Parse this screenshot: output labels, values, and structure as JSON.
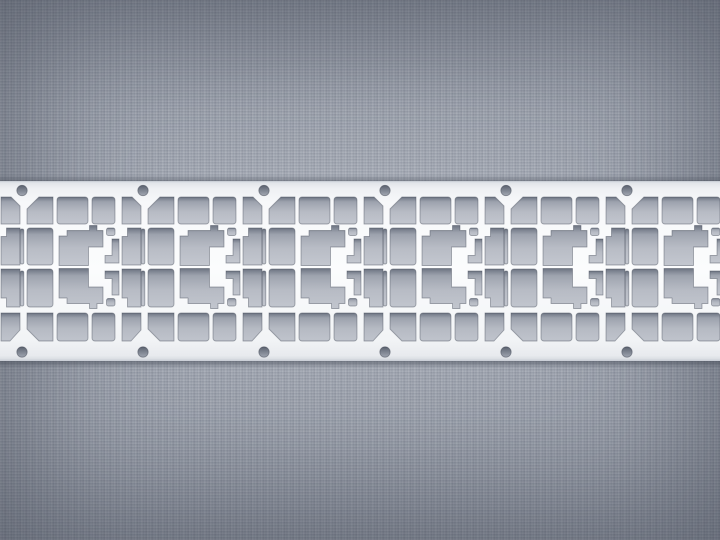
{
  "scene": {
    "description": "Macro photograph of a photo-etched silver metal leadframe strip with six repeating etched cells, lying horizontally across a gray woven fabric background",
    "background": {
      "fabric_base": "#9ea4b0",
      "fabric_highlight": "#aeb4bf",
      "fabric_shadow": "#7d8492",
      "vignette": "rgba(36,42,56,0.38)"
    },
    "strip": {
      "metal_color": "#f6f7f9",
      "metal_edge": "#c6cbd3",
      "contact_shadow": "#3e4450",
      "top": 181,
      "height": 180,
      "width": 720,
      "period": 121,
      "first_junction_x": 22,
      "cell_count": 7,
      "first_cell_index": -1,
      "hole_junction_count": 6,
      "holes": {
        "radius": 5.2,
        "top_cy": 9.5,
        "bottom_cy": 171,
        "fill_dark": "#525967",
        "fill_light": "#828997"
      },
      "cutout_fill_dark": "#5f6776",
      "cutout_fill_light": "#969caa",
      "cell_shapes": [
        {
          "t": "p",
          "n": "left-corner-top-cutout",
          "d": "M5 43 L5 28 L17 16 L31 16 L31 43 Z"
        },
        {
          "t": "r",
          "n": "left-pad-row2-cutout",
          "x": 5,
          "y": 47,
          "w": 26,
          "h": 37,
          "rx": 3
        },
        {
          "t": "r",
          "n": "left-pad-row3-cutout",
          "x": 5,
          "y": 88,
          "w": 26,
          "h": 38,
          "rx": 3
        },
        {
          "t": "p",
          "n": "left-corner-bottom-cutout",
          "d": "M5 132 L31 132 L31 160 L17 160 L5 148 Z"
        },
        {
          "t": "r",
          "n": "top-pad-wide-cutout",
          "x": 35,
          "y": 16,
          "w": 31,
          "h": 27,
          "rx": 3
        },
        {
          "t": "r",
          "n": "top-pad-narrow-cutout",
          "x": 70,
          "y": 16,
          "w": 23,
          "h": 27,
          "rx": 3
        },
        {
          "t": "r",
          "n": "bottom-pad-wide-cutout",
          "x": 35,
          "y": 132,
          "w": 31,
          "h": 28,
          "rx": 3
        },
        {
          "t": "r",
          "n": "bottom-pad-narrow-cutout",
          "x": 70,
          "y": 132,
          "w": 23,
          "h": 28,
          "rx": 3
        },
        {
          "t": "p",
          "n": "right-corner-top-cutout",
          "d": "M100 16 L110 16 L119 25 L119 43 L100 43 Z"
        },
        {
          "t": "p",
          "n": "right-pad-row2-cutout",
          "d": "M105.5 47 L119 47 L119 84 L100 84 L100 55.5 L105.5 55.5 Z"
        },
        {
          "t": "p",
          "n": "right-pad-row3-cutout",
          "d": "M100 88 L119 88 L119 126 L105.5 126 L105.5 117 L100 117 Z"
        },
        {
          "t": "p",
          "n": "right-corner-bottom-cutout",
          "d": "M100 132 L119 132 L119 149 L109 160 L100 160 Z"
        },
        {
          "t": "r",
          "n": "junction-slit-top-cutout",
          "x": -1.8,
          "y": 48,
          "w": 3.6,
          "h": 35,
          "rx": 1.6
        },
        {
          "t": "r",
          "n": "junction-slit-bottom-cutout",
          "x": -1.8,
          "y": 90,
          "w": 3.6,
          "h": 35,
          "rx": 1.6
        },
        {
          "t": "p",
          "n": "center-blob-top-cutout",
          "d": "M37 84.5 L37 55 L45 55 L45 49.5 L67.5 49.5 L67.5 44.5 L75 44.5 L75 49.5 L81 49.5 L81 66 L66.5 66 L66.5 84.5 Z"
        },
        {
          "t": "p",
          "n": "center-blob-bottom-cutout",
          "d": "M37 87.5 L66.5 87.5 L66.5 106 L81 106 L81 122.5 L75 122.5 L75 127.5 L67.5 127.5 L67.5 122.5 L45 122.5 L45 117 L37 117 Z"
        },
        {
          "t": "r",
          "n": "hook-square-top-cutout",
          "x": 84.5,
          "y": 47,
          "w": 8.5,
          "h": 7.5,
          "rx": 2
        },
        {
          "t": "p",
          "n": "hook-top-cutout",
          "d": "M90 58 L97 58 L97 82 L83 82 L83 74.5 L90 74.5 Z"
        },
        {
          "t": "p",
          "n": "hook-bottom-cutout",
          "d": "M83 90 L97 90 L97 114 L90 114 L90 97.5 L83 97.5 Z"
        },
        {
          "t": "r",
          "n": "hook-square-bottom-cutout",
          "x": 84.5,
          "y": 117.5,
          "w": 8.5,
          "h": 7.5,
          "rx": 2
        }
      ]
    }
  }
}
